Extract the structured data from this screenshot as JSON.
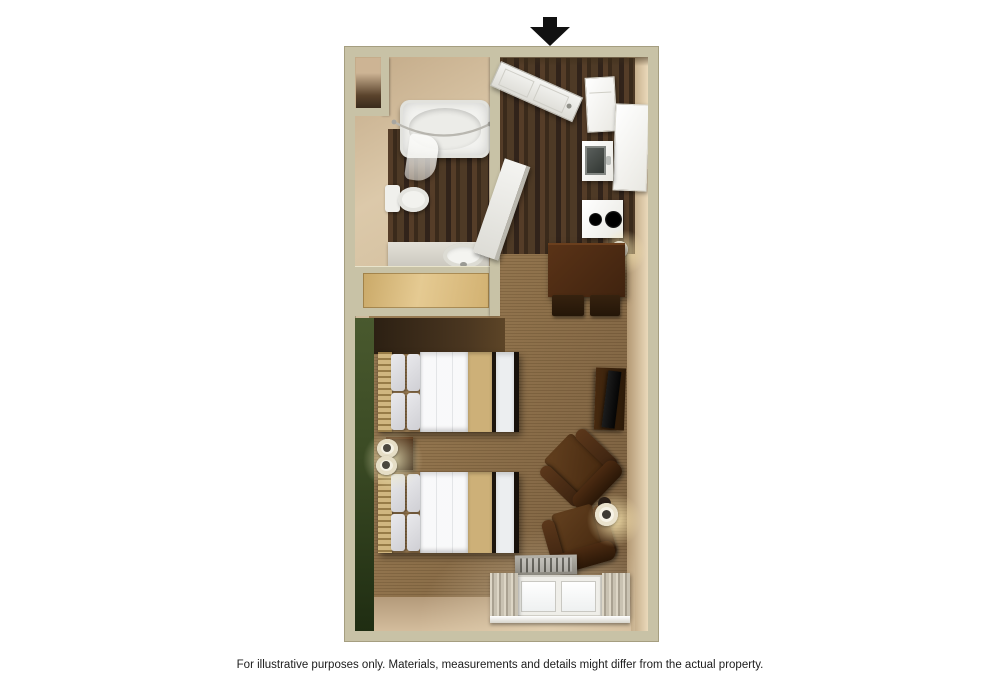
{
  "disclaimer": "For illustrative purposes only.  Materials, measurements and details might differ from the actual property.",
  "floorplan": {
    "type": "3d-top-view-studio-floorplan",
    "entrance": {
      "indicator": "down-arrow",
      "color": "#111111"
    },
    "rooms": [
      {
        "name": "bathroom",
        "features": [
          "bathtub",
          "shower-curtain-rod",
          "toilet",
          "vanity-sink",
          "dark-wood-floor",
          "corner-niche"
        ]
      },
      {
        "name": "entry-hall",
        "features": [
          "entry-door-open",
          "bathroom-door-open",
          "dark-wood-floor"
        ]
      },
      {
        "name": "kitchen",
        "features": [
          "refrigerator",
          "cabinet",
          "sink",
          "two-burner-cooktop",
          "wall-sconce"
        ]
      },
      {
        "name": "dining-area",
        "features": [
          "dark-wood-table",
          "two-chairs"
        ]
      },
      {
        "name": "closet",
        "features": [
          "tan-sliding-door"
        ]
      },
      {
        "name": "sleeping-area",
        "features": [
          "double-bed",
          "double-bed",
          "nightstand",
          "twin-lamps",
          "green-accent-wall"
        ]
      },
      {
        "name": "living-area",
        "features": [
          "tv",
          "media-console",
          "armchair",
          "armchair",
          "side-table-with-lamp"
        ]
      },
      {
        "name": "window-wall",
        "features": [
          "ac-unit",
          "double-window",
          "curtains"
        ]
      }
    ],
    "colors": {
      "background": "#ffffff",
      "wall": "#c8c2a6",
      "wall_face": "#d8c4a6",
      "wood_floor": "#46331f",
      "carpet": "#8a6c45",
      "accent_wall_green": "#3c4c25",
      "furniture_dark_brown": "#45280f",
      "bedding_white": "#eff1f3",
      "bed_runner_tan": "#cdb078",
      "appliance_white": "#f4f4f2",
      "arrow_black": "#111111"
    }
  }
}
